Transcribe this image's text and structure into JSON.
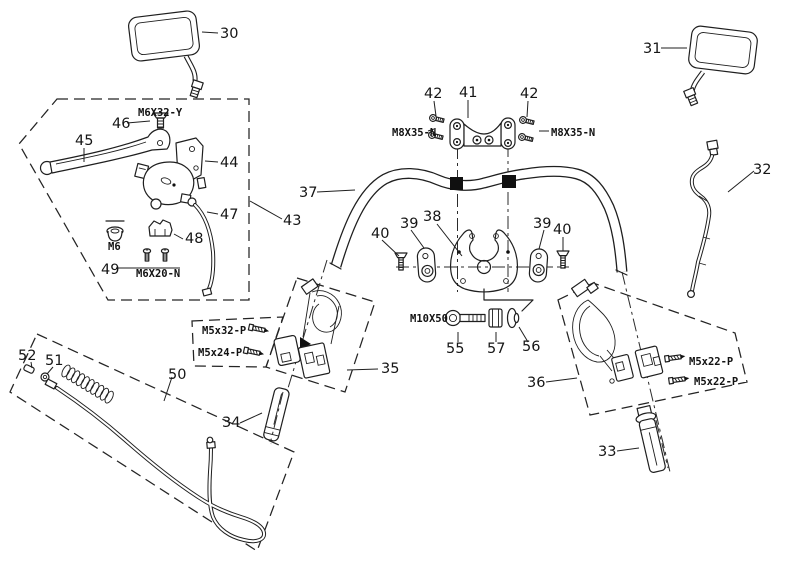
{
  "colors": {
    "ink": "#1f1f1f",
    "background": "#ffffff",
    "clamp_band": "#101010"
  },
  "parts": {
    "p30": "30",
    "p31": "31",
    "p32": "32",
    "p33": "33",
    "p34": "34",
    "p35": "35",
    "p36": "36",
    "p37": "37",
    "p38": "38",
    "p39_left": "39",
    "p39_right": "39",
    "p40_left": "40",
    "p40_right": "40",
    "p41": "41",
    "p42_left": "42",
    "p42_right": "42",
    "p43": "43",
    "p44": "44",
    "p45": "45",
    "p46": "46",
    "p47": "47",
    "p48": "48",
    "p49": "49",
    "p50": "50",
    "p51": "51",
    "p52": "52",
    "p55": "55",
    "p56": "56",
    "p57": "57"
  },
  "fastener_specs": {
    "m6x32_y": "M6X32-Y",
    "m8x35_n_left": "M8X35-N",
    "m8x35_n_right": "M8X35-N",
    "m6": "M6",
    "m6x20_n": "M6X20-N",
    "m5x32_p": "M5x32-P",
    "m5x24_p": "M5x24-P",
    "m10x50": "M10X50",
    "m5x22_p_top": "M5x22-P",
    "m5x22_p_bottom": "M5x22-P"
  }
}
